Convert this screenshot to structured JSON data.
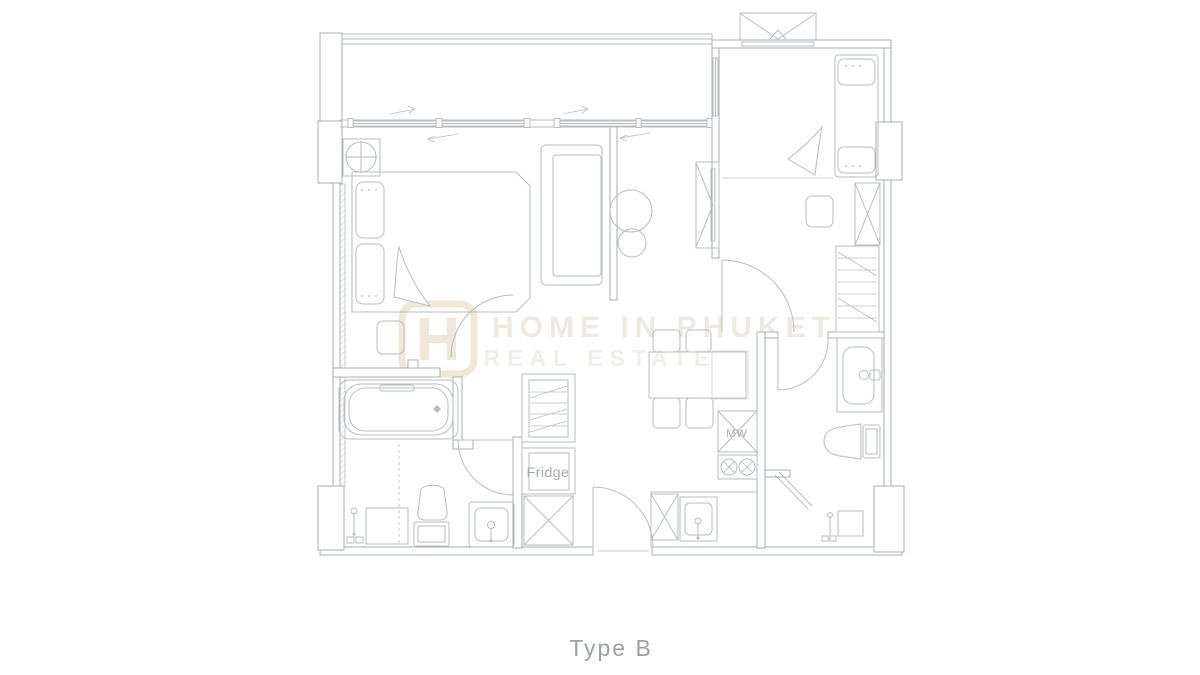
{
  "plan": {
    "title": "Type B",
    "labels": {
      "fridge": "Fridge",
      "microwave": "MW"
    },
    "watermark": {
      "line1": "HOME IN PHUKET",
      "line2": "REAL ESTATE"
    },
    "colors": {
      "line": "#b7bdc3",
      "wall": "#a8afb5",
      "label": "#a3a8ac",
      "title": "#9ba1a5",
      "watermark": "#d7cebb",
      "logo": "#dac7a4"
    }
  }
}
